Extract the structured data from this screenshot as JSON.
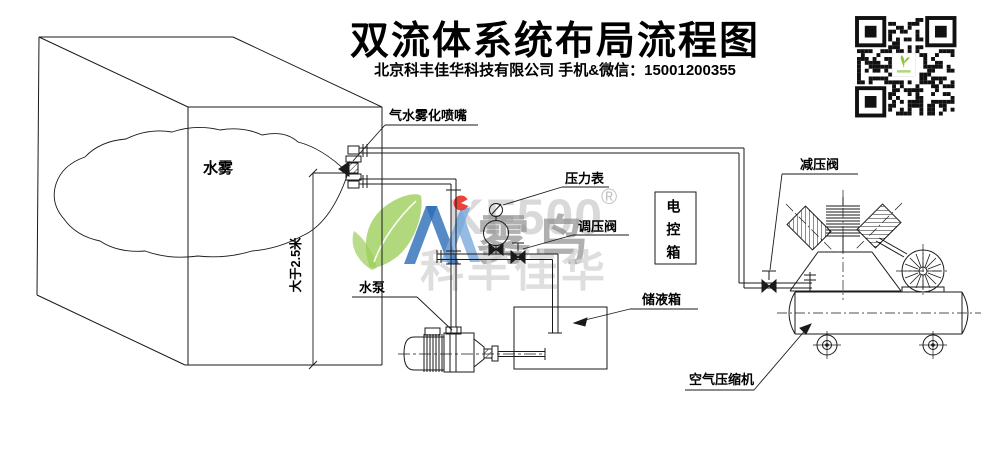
{
  "header": {
    "title": "双流体系统布局流程图",
    "subtitle": "北京科丰佳华科技有限公司 手机&微信：15001200355"
  },
  "labels": {
    "mist": "水雾",
    "nozzle": "气水雾化喷嘴",
    "height_note": "大于2.5米",
    "pressure_gauge": "压力表",
    "regulating_valve": "调压阀",
    "control_box": "电控箱",
    "liquid_tank": "储液箱",
    "water_pump": "水泵",
    "reducing_valve": "减压阀",
    "air_compressor": "空气压缩机"
  },
  "watermark": {
    "brand_letters": "KF500",
    "brand_name": "雾鸟",
    "registered": "®",
    "company_short": "科丰佳华"
  },
  "colors": {
    "line": "#1a1a1a",
    "watermark_green": "#8dc63f",
    "watermark_blue_dark": "#2a6db8",
    "watermark_blue_light": "#7aa9dc",
    "watermark_red": "#e8392f",
    "qr_dark": "#111111"
  }
}
